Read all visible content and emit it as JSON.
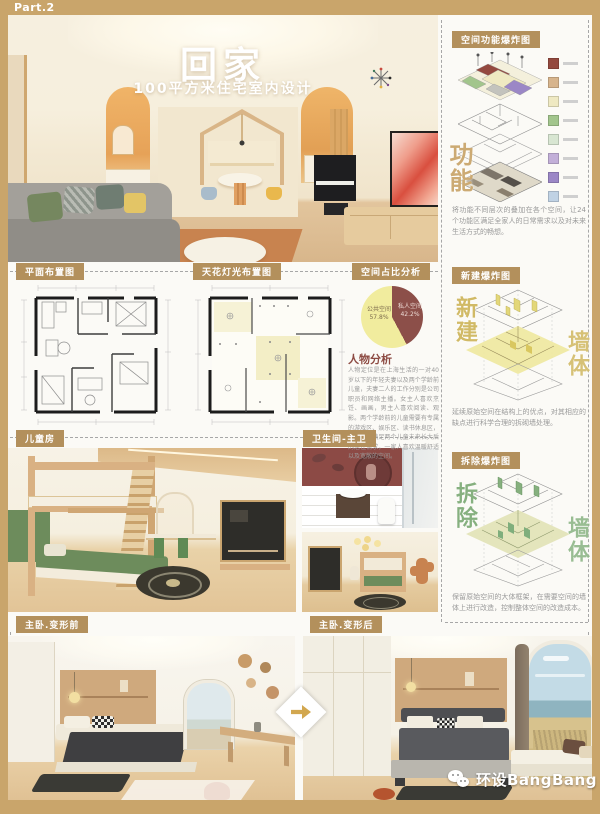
{
  "page": {
    "part_label": "Part.2",
    "brand_label": "环设BangBang"
  },
  "hero": {
    "title": "回家",
    "subtitle": "100平方米住宅室内设计"
  },
  "right_column": {
    "function_section": {
      "header": "空间功能爆炸图",
      "watermark": "功能",
      "description": "将功能不同层次的叠加在各个空间，让24个功能区满足全家人的日常需求以及对未来生活方式的畅想。",
      "legend_colors": [
        "#94493f",
        "#d7b48c",
        "#efe9c2",
        "#a2c58c",
        "#d8e6d2",
        "#c2afd8",
        "#9b87c6",
        "#c0d2e4"
      ]
    },
    "new_section": {
      "header": "新建爆炸图",
      "watermark_left": "新建",
      "watermark_right": "墙体",
      "description": "延续原始空间在结构上的优点，对其相应的缺点进行科学合理的拆砌墙处理。",
      "accent_color": "#d8c66e"
    },
    "demolish_section": {
      "header": "拆除爆炸图",
      "watermark_left": "拆除",
      "watermark_right": "墙体",
      "description": "保留原始空间的大体框架，在需要空间的墙体上进行改造，控制整体空间的改造成本。",
      "accent_color": "#7fae7c"
    }
  },
  "plans": {
    "floor_plan_header": "平面布置图",
    "ceiling_plan_header": "天花灯光布置图",
    "pie_header": "空间占比分析",
    "persona_heading": "人物分析",
    "persona_text": "人物定位是在上海生活的一对40岁以下的年轻夫妻以及两个学龄前儿童，夫妻二人的工作分别是公司职员和网络主播。女主人喜欢烹饪、画画，男主人喜欢阅读、观影。两个学龄前的儿童需要有专属的游戏区、娱乐区、读书休息区，设计还需满足两个儿童未来长大后的居住需求，一家人喜欢温暖舒适以及宽敞的空间。"
  },
  "chart_data": {
    "type": "pie",
    "title": "空间占比分析",
    "legend_position": "inside",
    "slices": [
      {
        "label": "公共空间",
        "value": 57.8,
        "pct_label": "57.8%",
        "color": "#f1ec9e"
      },
      {
        "label": "私人空间",
        "value": 42.2,
        "pct_label": "42.2%",
        "color": "#8c4f49"
      }
    ]
  },
  "photo_labels": {
    "kids_room": "儿童房",
    "bathroom": "卫生间-主卫",
    "bedroom_before": "主卧.变形前",
    "bedroom_after": "主卧.变形后"
  },
  "colors": {
    "frame_tan": "#c9a56b",
    "chip_brown": "#b3905c",
    "persona_red": "#8c4a42"
  }
}
